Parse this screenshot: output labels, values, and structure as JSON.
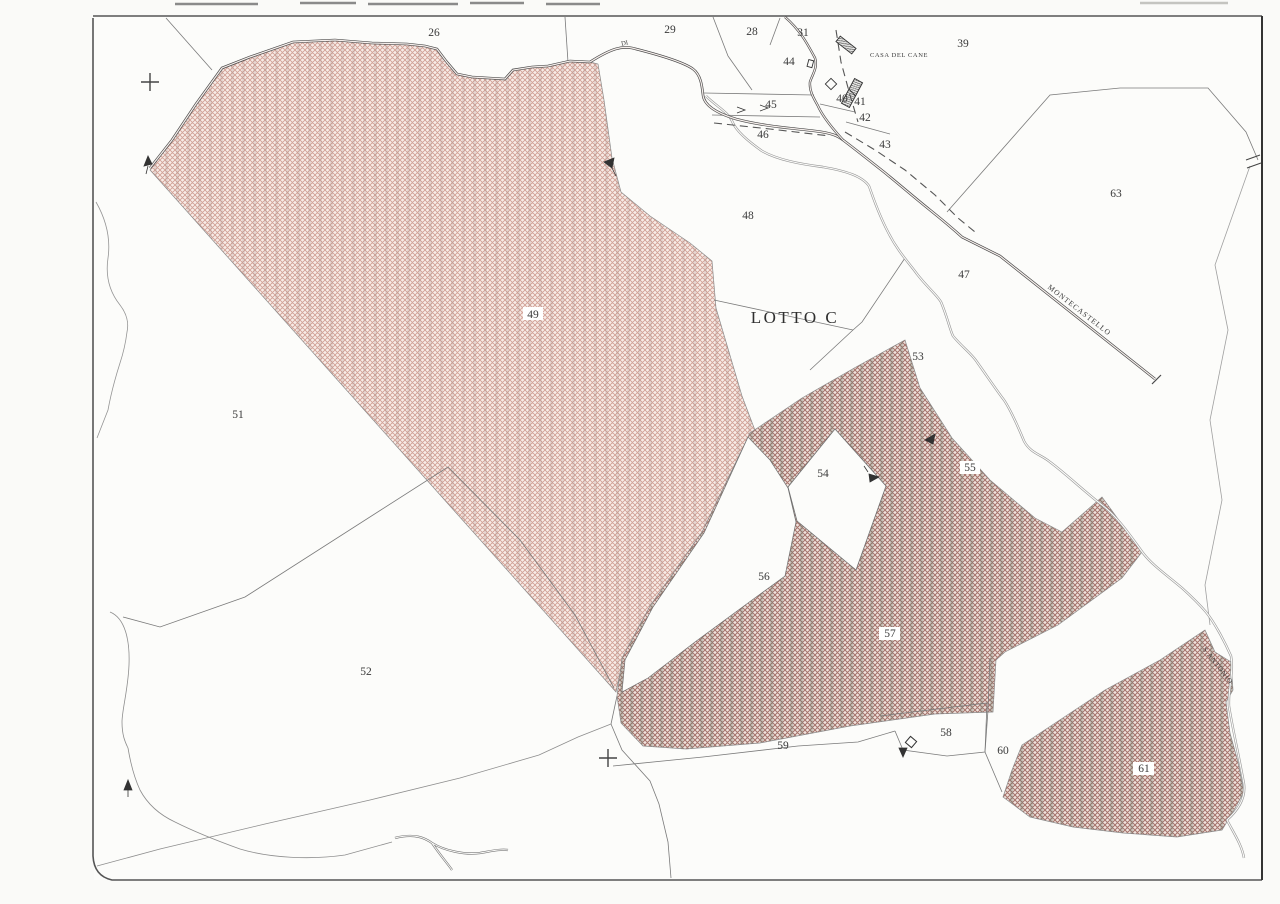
{
  "page": {
    "title": "Cadastral plan scan - LOTTO C"
  },
  "map": {
    "zone_title": "LOTTO C",
    "place_labels": {
      "casa_del_cane": "CASA DEL CANE",
      "montecastello": "MONTECASTELLO",
      "s_antonio": "S.ANTONIO",
      "di": "DI"
    },
    "parcel_numbers": {
      "p26": "26",
      "p28": "28",
      "p29": "29",
      "p31": "31",
      "p39": "39",
      "p40": "40",
      "p41": "41",
      "p42": "42",
      "p43": "43",
      "p44": "44",
      "p45": "45",
      "p46": "46",
      "p47": "47",
      "p48": "48",
      "p49": "49",
      "p51": "51",
      "p52": "52",
      "p53": "53",
      "p54": "54",
      "p55": "55",
      "p56": "56",
      "p57": "57",
      "p58": "58",
      "p59": "59",
      "p60": "60",
      "p61": "61",
      "p63": "63"
    },
    "colors": {
      "paper": "#fbfbf9",
      "boundary_line": "#6f6f6f",
      "road_line": "#4a4a4a",
      "stream_line": "#9a9a9a",
      "hatch_pink": "#cf9d92",
      "hatch_dark": "#a4726b",
      "stripe_tint": "#7d8a7d"
    }
  }
}
